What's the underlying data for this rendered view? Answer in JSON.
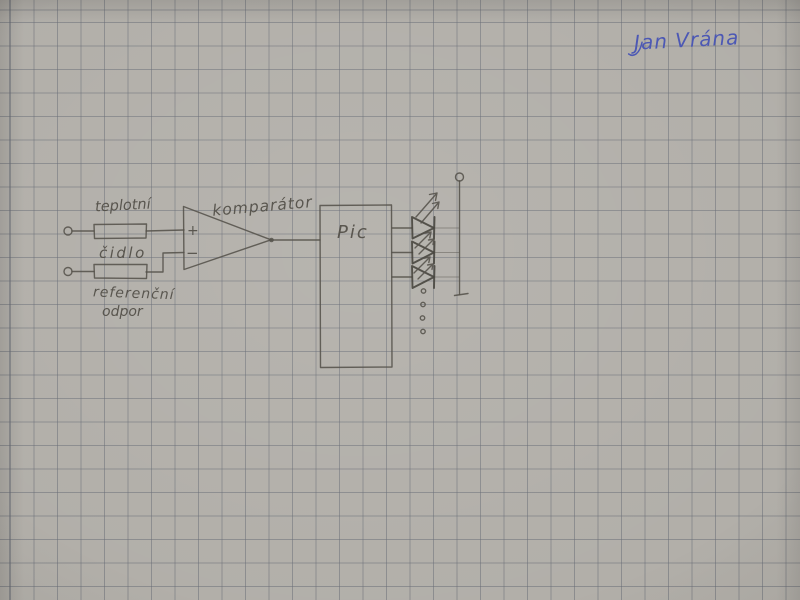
{
  "paper": {
    "base_color": "#b1aea8",
    "grid_color": "#83868f",
    "grid_size_px": 23.5
  },
  "ink": {
    "pencil_color": "#55524b",
    "pen_color": "#4c58b4"
  },
  "signature": {
    "text": "Jan Vrána"
  },
  "schematic": {
    "labels": {
      "sensor_line1": "teplotní",
      "sensor_line2": "čidlo",
      "reference_line1": "referenční",
      "reference_line2": "odpor",
      "comparator": "komparátor",
      "mcu": "Pic",
      "noninverting_input": "+",
      "inverting_input": "−"
    }
  }
}
